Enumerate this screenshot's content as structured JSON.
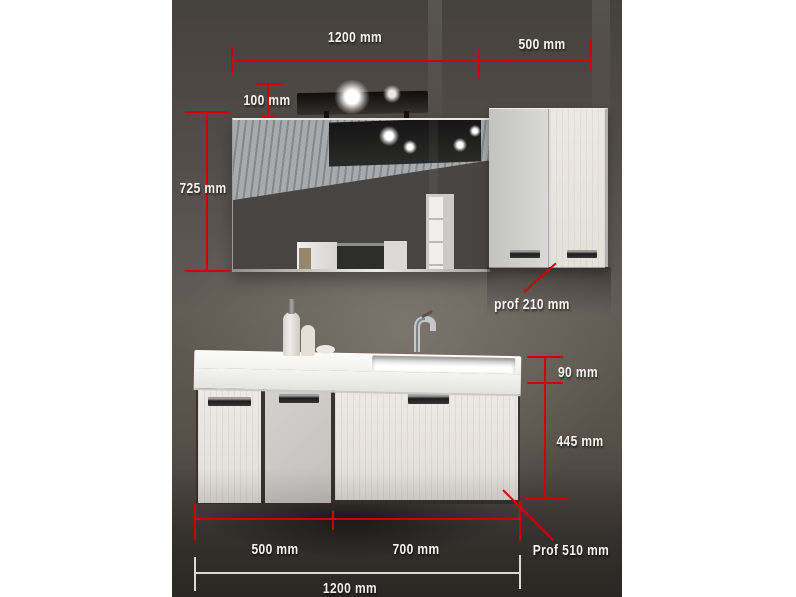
{
  "meta": {
    "description": "Product photo of a wall-hung bathroom vanity set (mirror with lamp, wall cabinet, washbasin unit) annotated with dimension lines"
  },
  "colors": {
    "dimension_line": "#d10008",
    "dimension_text": "#f5f3ef",
    "total_width_line": "#dad9d6",
    "wall": "#5a544e"
  },
  "annotations": {
    "mirror_width": "1200 mm",
    "wall_cabinet_width": "500 mm",
    "lamp_height": "100 mm",
    "mirror_height": "725 mm",
    "wall_cabinet_depth": "prof 210 mm",
    "basin_height": "90 mm",
    "base_unit_height": "445 mm",
    "base_left_width": "500 mm",
    "base_right_width": "700 mm",
    "base_unit_depth": "Prof 510 mm",
    "total_width": "1200 mm"
  }
}
